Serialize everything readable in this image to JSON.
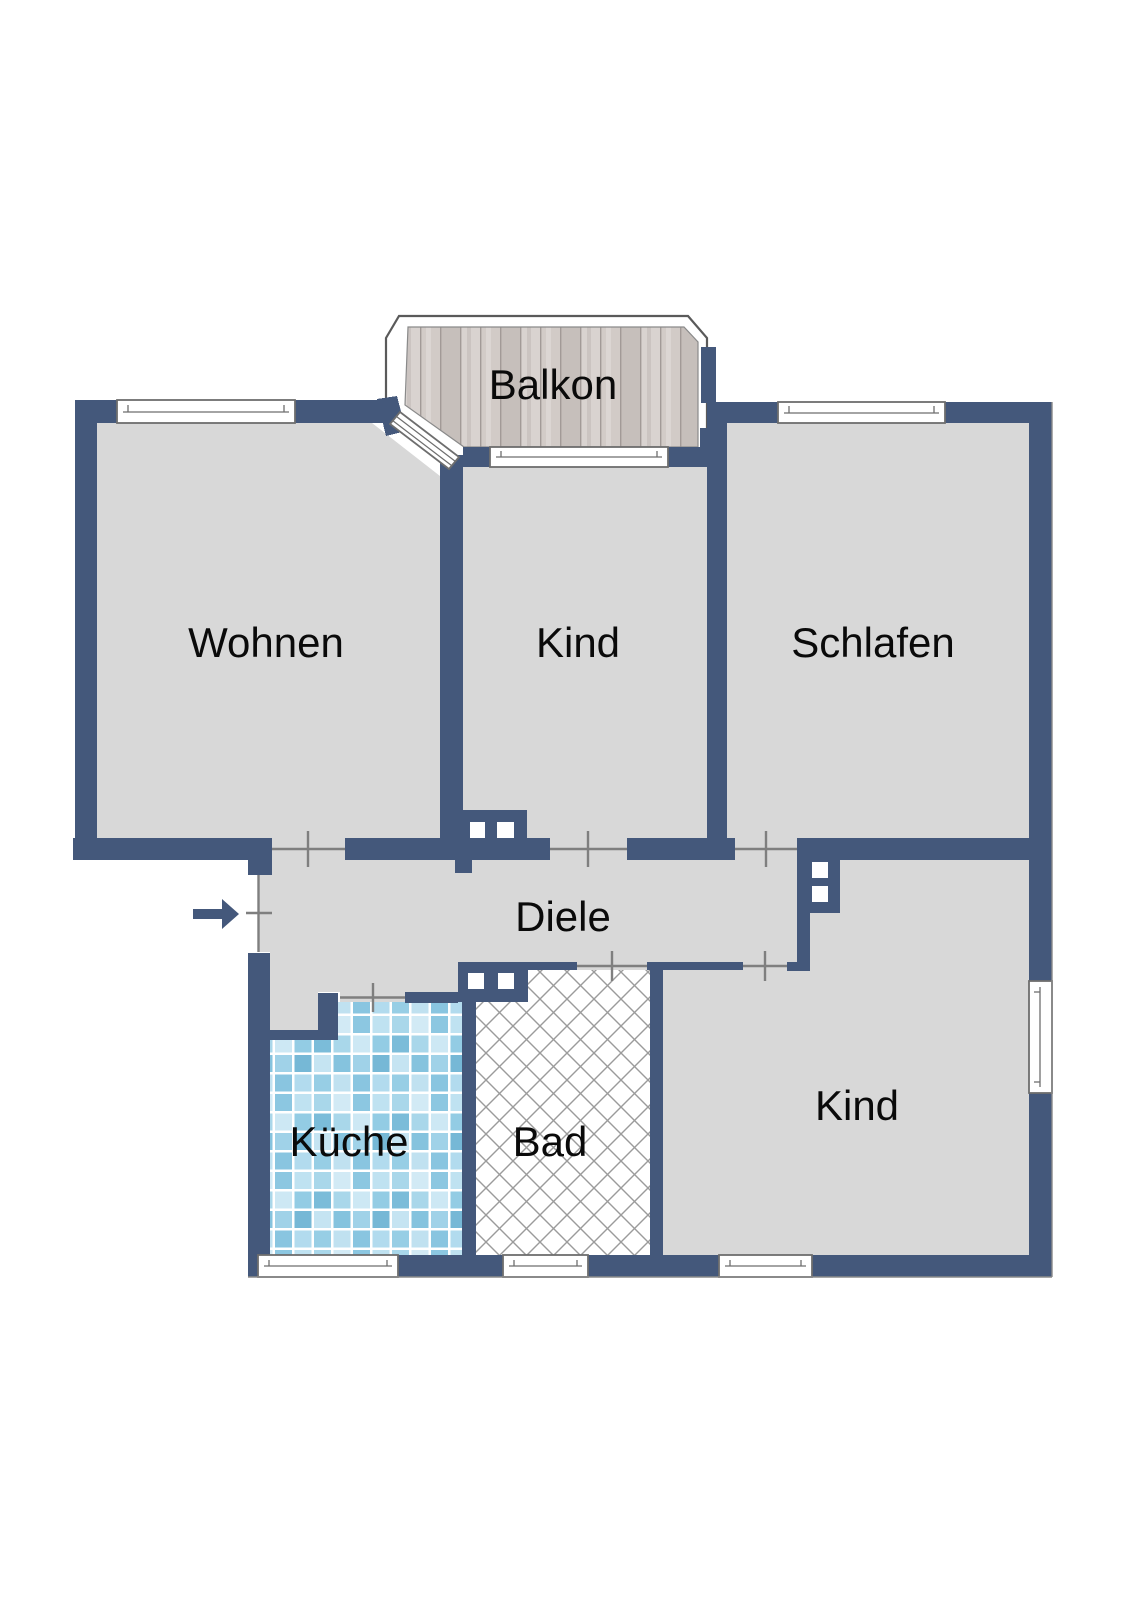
{
  "plan": {
    "kind": "apartment-floor-plan",
    "rooms": [
      {
        "id": "balkon",
        "label": "Balkon"
      },
      {
        "id": "wohnen",
        "label": "Wohnen"
      },
      {
        "id": "kind-oben",
        "label": "Kind"
      },
      {
        "id": "schlafen",
        "label": "Schlafen"
      },
      {
        "id": "diele",
        "label": "Diele"
      },
      {
        "id": "kueche",
        "label": "Küche"
      },
      {
        "id": "bad",
        "label": "Bad"
      },
      {
        "id": "kind-unten",
        "label": "Kind"
      }
    ],
    "entrance": {
      "icon": "arrow-right-icon"
    },
    "colors": {
      "wall": "#44587b",
      "floor": "#d8d8d8",
      "balcony_deck": "#cdc6c2",
      "kitchen_tile": "#8cc7e1",
      "bath_hatch": "#9b9b9b",
      "door_line": "#7f7f7f",
      "window_fill": "#ffffff",
      "label_text": "#0a0a0a"
    }
  }
}
